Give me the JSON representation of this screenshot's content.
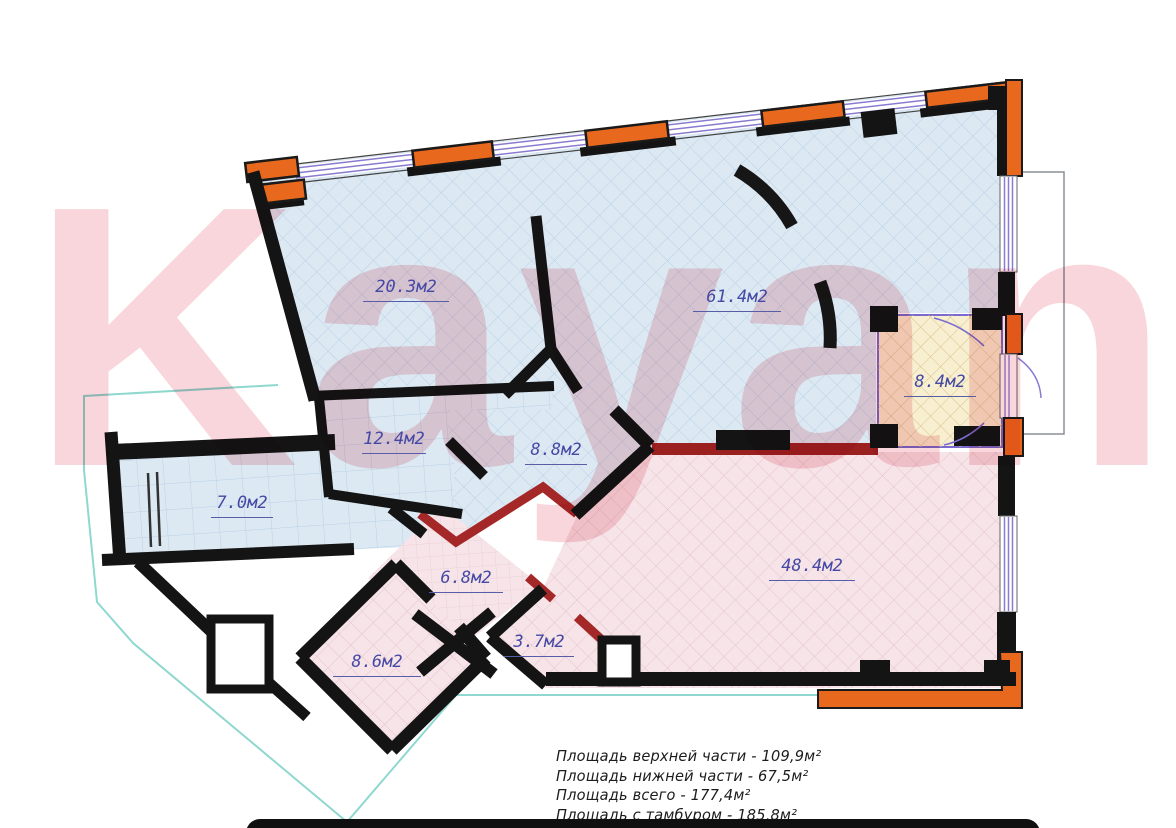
{
  "watermark_text": "Kayan",
  "rooms": [
    {
      "name": "room-20-3",
      "area_label": "20.3м2"
    },
    {
      "name": "room-61-4",
      "area_label": "61.4м2"
    },
    {
      "name": "room-8-4",
      "area_label": "8.4м2"
    },
    {
      "name": "room-12-4",
      "area_label": "12.4м2"
    },
    {
      "name": "room-8-8",
      "area_label": "8.8м2"
    },
    {
      "name": "room-7-0",
      "area_label": "7.0м2"
    },
    {
      "name": "room-48-4",
      "area_label": "48.4м2"
    },
    {
      "name": "room-6-8",
      "area_label": "6.8м2"
    },
    {
      "name": "room-3-7",
      "area_label": "3.7м2"
    },
    {
      "name": "room-8-6",
      "area_label": "8.6м2"
    }
  ],
  "summary_lines": [
    "Площадь верхней части - 109,9м²",
    "Площадь нижней части - 67,5м²",
    "Площадь всего - 177,4м²",
    "Площадь с тамбуром - 185,8м²"
  ],
  "colors": {
    "upper_zone_fill": "#dce9f3",
    "lower_zone_fill": "#f6e4e8",
    "tambour_room_fill": "#f7efcf",
    "wall_black": "#141414",
    "perimeter_orange": "#e8691e",
    "accent_red_wall": "#9b2020",
    "window_purple": "#8a7ad0",
    "room_label_blue": "#4549a4",
    "outline_teal": "#8fd8cf"
  }
}
